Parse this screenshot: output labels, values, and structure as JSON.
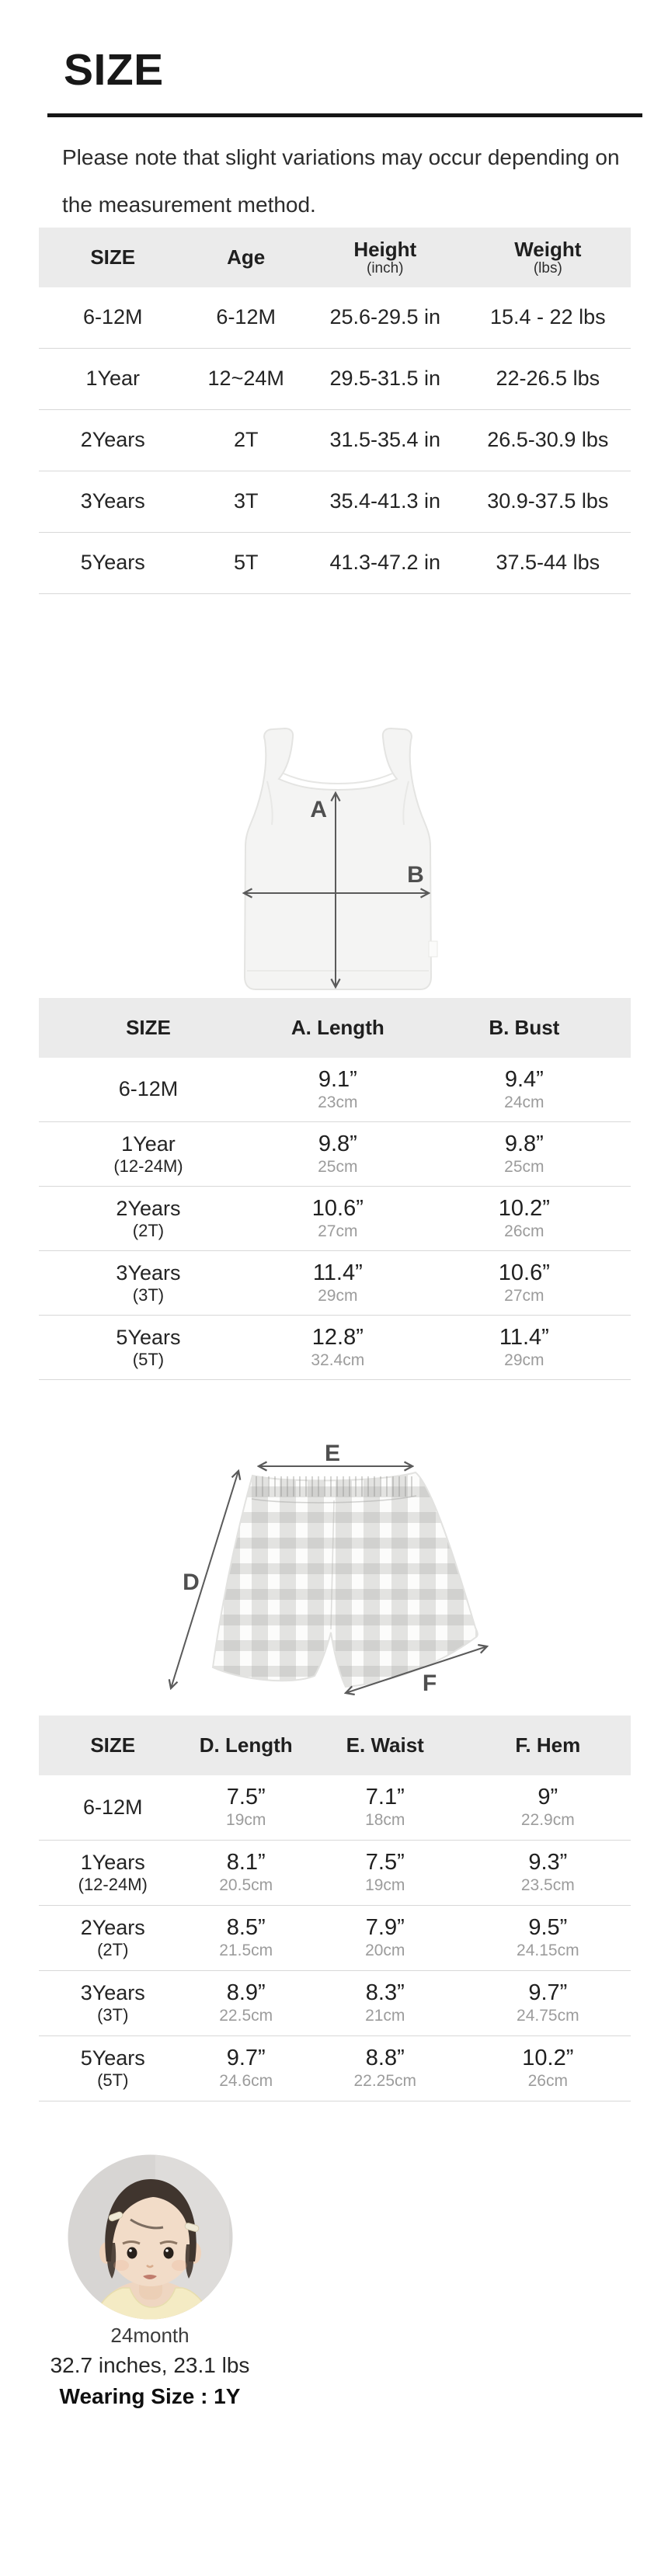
{
  "page": {
    "title": "SIZE",
    "note_lines": [
      "Please note that slight variations may occur depending on",
      "the measurement method."
    ]
  },
  "colors": {
    "header_bg": "#ebebeb",
    "divider": "#151515",
    "text": "#242424",
    "muted_text": "#9c9c9c",
    "row_separator": "#d8d8d8",
    "diagram_label": "#4f4f4f",
    "model_photo_bg": "#d7d5d3",
    "model_top_yellow": "#f4ebc4"
  },
  "general_chart": {
    "headers": {
      "size": "SIZE",
      "age": "Age",
      "height": "Height",
      "height_unit": "(inch)",
      "weight": "Weight",
      "weight_unit": "(lbs)"
    },
    "rows": [
      {
        "size": "6-12M",
        "age": "6-12M",
        "height": "25.6-29.5 in",
        "weight": "15.4 - 22 lbs"
      },
      {
        "size": "1Year",
        "age": "12~24M",
        "height": "29.5-31.5 in",
        "weight": "22-26.5 lbs"
      },
      {
        "size": "2Years",
        "age": "2T",
        "height": "31.5-35.4 in",
        "weight": "26.5-30.9 lbs"
      },
      {
        "size": "3Years",
        "age": "3T",
        "height": "35.4-41.3 in",
        "weight": "30.9-37.5 lbs"
      },
      {
        "size": "5Years",
        "age": "5T",
        "height": "41.3-47.2 in",
        "weight": "37.5-44 lbs"
      }
    ]
  },
  "top_diagram": {
    "length_label": "A",
    "bust_label": "B"
  },
  "top_chart": {
    "headers": {
      "size": "SIZE",
      "length": "A. Length",
      "bust": "B. Bust"
    },
    "rows": [
      {
        "size": "6-12M",
        "size_sub": "",
        "length_in": "9.1”",
        "length_cm": "23cm",
        "bust_in": "9.4”",
        "bust_cm": "24cm"
      },
      {
        "size": "1Year",
        "size_sub": "(12-24M)",
        "length_in": "9.8”",
        "length_cm": "25cm",
        "bust_in": "9.8”",
        "bust_cm": "25cm"
      },
      {
        "size": "2Years",
        "size_sub": "(2T)",
        "length_in": "10.6”",
        "length_cm": "27cm",
        "bust_in": "10.2”",
        "bust_cm": "26cm"
      },
      {
        "size": "3Years",
        "size_sub": "(3T)",
        "length_in": "11.4”",
        "length_cm": "29cm",
        "bust_in": "10.6”",
        "bust_cm": "27cm"
      },
      {
        "size": "5Years",
        "size_sub": "(5T)",
        "length_in": "12.8”",
        "length_cm": "32.4cm",
        "bust_in": "11.4”",
        "bust_cm": "29cm"
      }
    ]
  },
  "bottom_diagram": {
    "length_label": "D",
    "waist_label": "E",
    "hem_label": "F"
  },
  "bottom_chart": {
    "headers": {
      "size": "SIZE",
      "length": "D. Length",
      "waist": "E. Waist",
      "hem": "F. Hem"
    },
    "rows": [
      {
        "size": "6-12M",
        "size_sub": "",
        "length_in": "7.5”",
        "length_cm": "19cm",
        "waist_in": "7.1”",
        "waist_cm": "18cm",
        "hem_in": "9”",
        "hem_cm": "22.9cm"
      },
      {
        "size": "1Years",
        "size_sub": "(12-24M)",
        "length_in": "8.1”",
        "length_cm": "20.5cm",
        "waist_in": "7.5”",
        "waist_cm": "19cm",
        "hem_in": "9.3”",
        "hem_cm": "23.5cm"
      },
      {
        "size": "2Years",
        "size_sub": "(2T)",
        "length_in": "8.5”",
        "length_cm": "21.5cm",
        "waist_in": "7.9”",
        "waist_cm": "20cm",
        "hem_in": "9.5”",
        "hem_cm": "24.15cm"
      },
      {
        "size": "3Years",
        "size_sub": "(3T)",
        "length_in": "8.9”",
        "length_cm": "22.5cm",
        "waist_in": "8.3”",
        "waist_cm": "21cm",
        "hem_in": "9.7”",
        "hem_cm": "24.75cm"
      },
      {
        "size": "5Years",
        "size_sub": "(5T)",
        "length_in": "9.7”",
        "length_cm": "24.6cm",
        "waist_in": "8.8”",
        "waist_cm": "22.25cm",
        "hem_in": "10.2”",
        "hem_cm": "26cm"
      }
    ]
  },
  "model": {
    "age": "24month",
    "stats": "32.7 inches, 23.1 lbs",
    "wearing_size": "Wearing Size : 1Y"
  }
}
